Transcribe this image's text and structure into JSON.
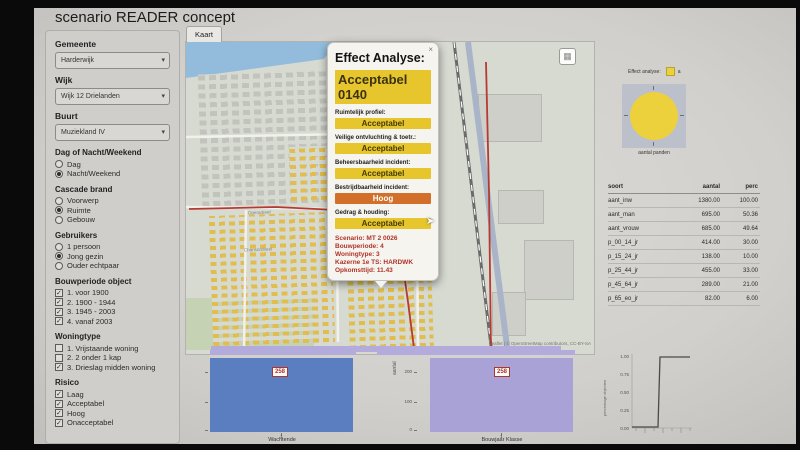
{
  "title": "scenario READER concept",
  "tabs": {
    "kaart": "Kaart"
  },
  "colors": {
    "accent_yellow": "#e7c52c",
    "accent_orange": "#d2702b",
    "popup_red_text": "#b03228",
    "bar_blue": "#5b7ec0",
    "bar_purple": "#a9a2d6",
    "pie_yellow": "#edd13c",
    "map_route_red": "#b73a32"
  },
  "sidebar": {
    "selects": [
      {
        "label": "Gemeente",
        "value": "Harderwijk"
      },
      {
        "label": "Wijk",
        "value": "Wijk 12 Drielanden"
      },
      {
        "label": "Buurt",
        "value": "Muziekland IV"
      }
    ],
    "radio_groups": [
      {
        "heading": "Dag of Nacht/Weekend",
        "options": [
          {
            "label": "Dag",
            "checked": false
          },
          {
            "label": "Nacht/Weekend",
            "checked": true
          }
        ]
      },
      {
        "heading": "Cascade brand",
        "options": [
          {
            "label": "Voorwerp",
            "checked": false
          },
          {
            "label": "Ruimte",
            "checked": true
          },
          {
            "label": "Gebouw",
            "checked": false
          }
        ]
      },
      {
        "heading": "Gebruikers",
        "options": [
          {
            "label": "1 persoon",
            "checked": false
          },
          {
            "label": "Jong gezin",
            "checked": true
          },
          {
            "label": "Ouder echtpaar",
            "checked": false
          }
        ]
      }
    ],
    "checkbox_groups": [
      {
        "heading": "Bouwperiode object",
        "options": [
          {
            "label": "1. voor 1900",
            "checked": true
          },
          {
            "label": "2. 1900 - 1944",
            "checked": true
          },
          {
            "label": "3. 1945 - 2003",
            "checked": true
          },
          {
            "label": "4. vanaf 2003",
            "checked": true
          }
        ]
      },
      {
        "heading": "Woningtype",
        "options": [
          {
            "label": "1. Vrijstaande woning",
            "checked": false
          },
          {
            "label": "2. 2 onder 1 kap",
            "checked": false
          },
          {
            "label": "3. Drieslag midden woning",
            "checked": true
          }
        ]
      },
      {
        "heading": "Risico",
        "options": [
          {
            "label": "Laag",
            "checked": true
          },
          {
            "label": "Acceptabel",
            "checked": true
          },
          {
            "label": "Hoog",
            "checked": true
          },
          {
            "label": "Onacceptabel",
            "checked": true
          }
        ]
      }
    ]
  },
  "map": {
    "attribution": "Leaflet | © OpenStreetMap contributors, CC-BY-SA",
    "street_labels": [
      "Operadreef",
      "Operadreef",
      "Chansondreef"
    ]
  },
  "popup": {
    "title": "Effect Analyse:",
    "close": "×",
    "headline": "Acceptabel 0140",
    "metrics": [
      {
        "label": "Ruimtelijk profiel:",
        "value": "Acceptabel",
        "level": "yellow"
      },
      {
        "label": "Veilige ontvluchting & toetr.:",
        "value": "Acceptabel",
        "level": "yellow"
      },
      {
        "label": "Beheersbaarheid incident:",
        "value": "Acceptabel",
        "level": "yellow"
      },
      {
        "label": "Bestrijdbaarheid incident:",
        "value": "Hoog",
        "level": "orange"
      },
      {
        "label": "Gedrag & houding:",
        "value": "Acceptabel",
        "level": "yellow"
      }
    ],
    "details": [
      "Scenario: MT 2 0026",
      "Bouwperiode: 4",
      "Woningtype: 3",
      "Kazerne 1e TS: HARDWK",
      "Opkomsttijd: 11.43"
    ]
  },
  "right_panel": {
    "legend_label": "Effect analyse:",
    "legend_item": "a",
    "pie_caption": "aantal panden",
    "table": {
      "headers": [
        "soort",
        "aantal",
        "perc"
      ],
      "rows": [
        [
          "aant_inw",
          "1380.00",
          "100.00"
        ],
        [
          "aant_man",
          "695.00",
          "50.36"
        ],
        [
          "aant_vrouw",
          "685.00",
          "49.64"
        ],
        [
          "p_00_14_jr",
          "414.00",
          "30.00"
        ],
        [
          "p_15_24_jr",
          "138.00",
          "10.00"
        ],
        [
          "p_25_44_jr",
          "455.00",
          "33.00"
        ],
        [
          "p_45_64_jr",
          "289.00",
          "21.00"
        ],
        [
          "p_65_eo_jr",
          "82.00",
          "6.00"
        ]
      ]
    }
  },
  "bottom_charts": {
    "left": {
      "value_label": "258",
      "x_tick": "1",
      "xlabel": "Wachtende"
    },
    "middle_axis": {
      "ylabel": "aantal",
      "ticks": [
        "200",
        "100",
        "0"
      ]
    },
    "right": {
      "value_label": "258",
      "x_tick": "1",
      "xlabel": "Bouwjaar Klasse"
    },
    "ecdf": {
      "ylabel": "percentage objecten",
      "y_ticks": [
        "1.00",
        "0.75",
        "0.50",
        "0.25",
        "0.00"
      ]
    }
  },
  "chart_data": [
    {
      "type": "pie",
      "title": "Effect analyse",
      "caption": "aantal panden",
      "series": [
        {
          "name": "a",
          "value": 258,
          "percent": 100,
          "color": "#edd13c"
        }
      ],
      "legend_position": "top"
    },
    {
      "type": "bar",
      "xlabel": "Wachtende",
      "categories": [
        "1"
      ],
      "values": [
        258
      ],
      "bar_labels": [
        "258"
      ],
      "color": "#5b7ec0",
      "ylim": [
        0,
        260
      ]
    },
    {
      "type": "bar",
      "xlabel": "Bouwjaar Klasse",
      "ylabel": "aantal",
      "categories": [
        "1"
      ],
      "values": [
        258
      ],
      "bar_labels": [
        "258"
      ],
      "color": "#a9a2d6",
      "y_ticks": [
        200,
        100,
        0
      ],
      "ylim": [
        0,
        260
      ]
    },
    {
      "type": "line",
      "subtype": "step-ecdf",
      "ylabel": "percentage objecten",
      "y_ticks": [
        1.0,
        0.75,
        0.5,
        0.25,
        0.0
      ],
      "x": [
        0,
        11.4,
        11.43,
        20
      ],
      "y": [
        0,
        0,
        1,
        1
      ],
      "note": "all objects reached at Opkomsttijd ~11.43"
    },
    {
      "type": "table",
      "headers": [
        "soort",
        "aantal",
        "perc"
      ],
      "rows": [
        [
          "aant_inw",
          1380.0,
          100.0
        ],
        [
          "aant_man",
          695.0,
          50.36
        ],
        [
          "aant_vrouw",
          685.0,
          49.64
        ],
        [
          "p_00_14_jr",
          414.0,
          30.0
        ],
        [
          "p_15_24_jr",
          138.0,
          10.0
        ],
        [
          "p_25_44_jr",
          455.0,
          33.0
        ],
        [
          "p_45_64_jr",
          289.0,
          21.0
        ],
        [
          "p_65_eo_jr",
          82.0,
          6.0
        ]
      ]
    }
  ]
}
